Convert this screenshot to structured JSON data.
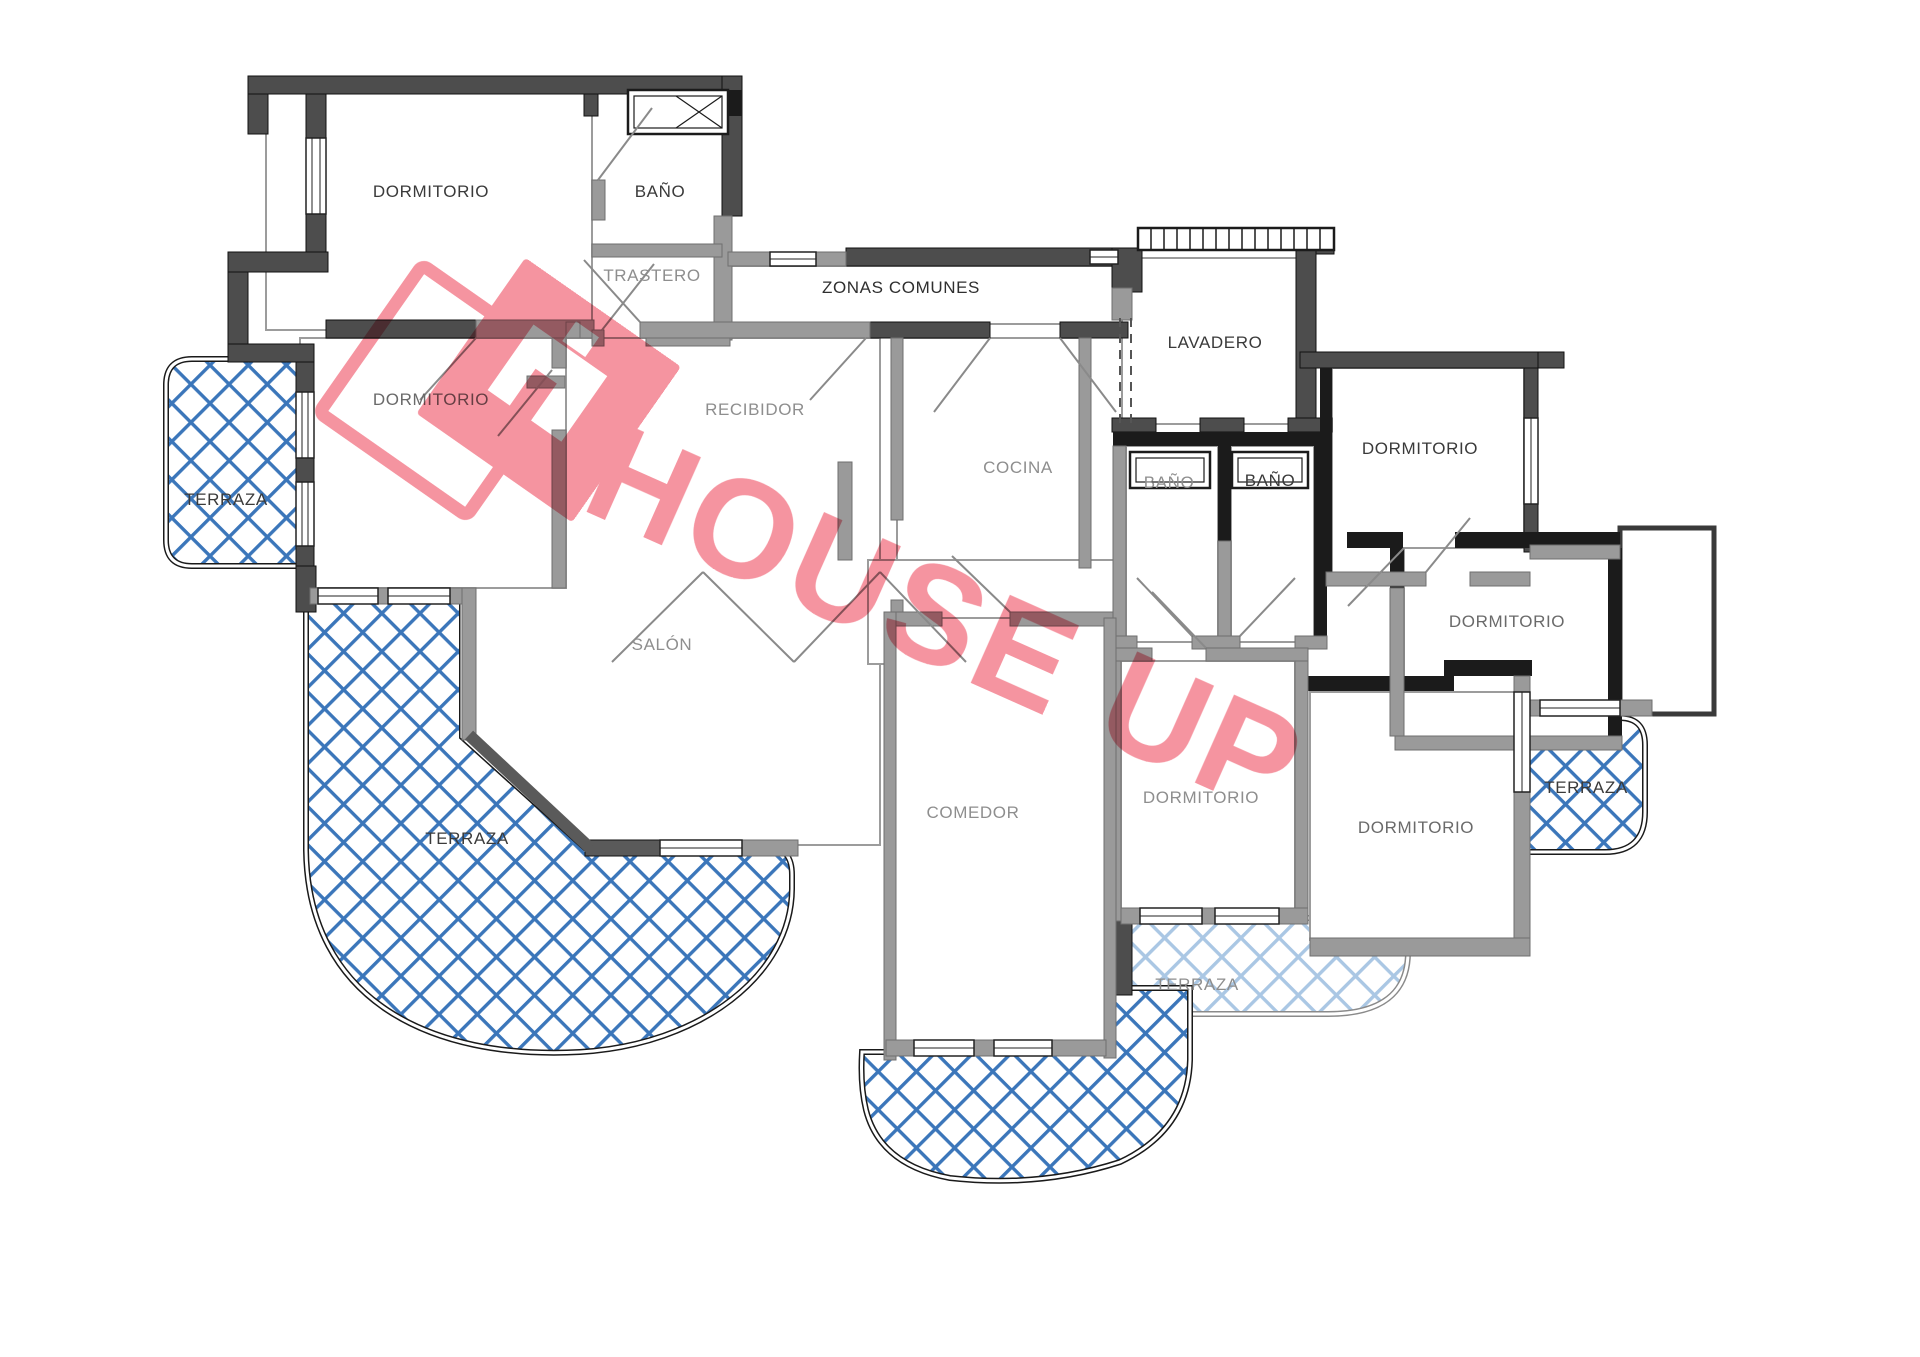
{
  "watermark": {
    "brand": "HOUSE UP",
    "color": "#f4818f"
  },
  "floor_plan": {
    "rooms": [
      {
        "id": "dormitorio-1",
        "label": "DORMITORIO"
      },
      {
        "id": "bano-1",
        "label": "BAÑO"
      },
      {
        "id": "trastero",
        "label": "TRASTERO"
      },
      {
        "id": "zonas-comunes",
        "label": "ZONAS COMUNES"
      },
      {
        "id": "dormitorio-2",
        "label": "DORMITORIO"
      },
      {
        "id": "recibidor",
        "label": "RECIBIDOR"
      },
      {
        "id": "cocina",
        "label": "COCINA"
      },
      {
        "id": "lavadero",
        "label": "LAVADERO"
      },
      {
        "id": "bano-2",
        "label": "BAÑO"
      },
      {
        "id": "bano-3",
        "label": "BAÑO"
      },
      {
        "id": "dormitorio-3",
        "label": "DORMITORIO"
      },
      {
        "id": "terraza-izquierda",
        "label": "TERRAZA"
      },
      {
        "id": "salon",
        "label": "SALÓN"
      },
      {
        "id": "dormitorio-4",
        "label": "DORMITORIO"
      },
      {
        "id": "comedor",
        "label": "COMEDOR"
      },
      {
        "id": "dormitorio-5",
        "label": "DORMITORIO"
      },
      {
        "id": "dormitorio-6",
        "label": "DORMITORIO"
      },
      {
        "id": "terraza-grande",
        "label": "TERRAZA"
      },
      {
        "id": "terraza-central",
        "label": "TERRAZA"
      },
      {
        "id": "terraza-derecha",
        "label": "TERRAZA"
      }
    ],
    "colors": {
      "wall_dark": "#4d4d4d",
      "wall_light": "#9a9a9a",
      "wall_black": "#1b1b1b",
      "terrace_hatch": "#3b76ba",
      "terrace_hatch_light": "#aac7e4",
      "label_dark": "#3a3a3a",
      "label_gray": "#8e8e8e",
      "watermark_pink": "#f4818f"
    }
  }
}
